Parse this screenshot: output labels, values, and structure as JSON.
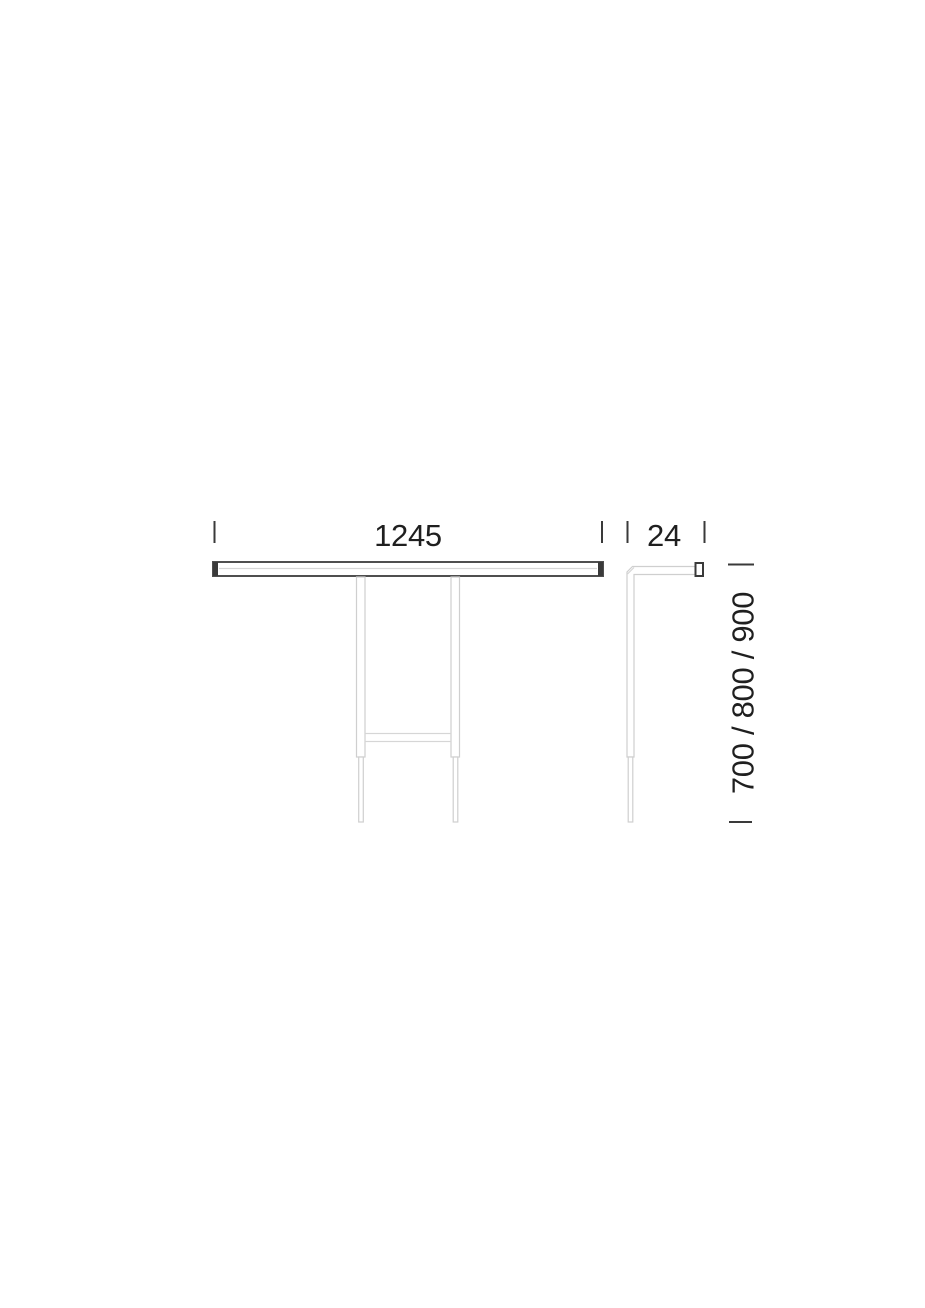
{
  "drawing": {
    "dimensions": {
      "width": {
        "label": "1245"
      },
      "depth": {
        "label": "24"
      },
      "height": {
        "label": "700 / 800 / 900"
      }
    },
    "colors": {
      "dimension_text": "#1f1f1f",
      "tick": "#3a3a3a",
      "outline_light": "#cfcfcf",
      "outline_lighter": "#d6d6d6",
      "outline_dark": "#4f4f4f",
      "end_cap": "#3a3a3a",
      "background": "#ffffff"
    }
  }
}
